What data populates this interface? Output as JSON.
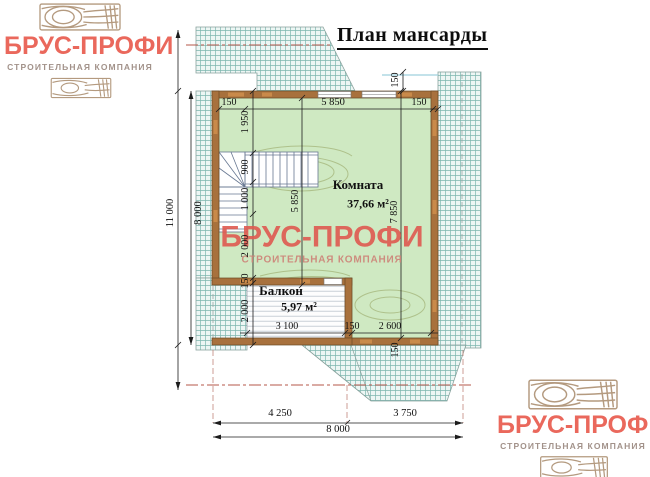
{
  "brand": {
    "name": "БРУС-ПРОФИ",
    "tagline": "СТРОИТЕЛЬНАЯ КОМПАНИЯ"
  },
  "title": "План мансарды",
  "rooms": {
    "room": {
      "name": "Комната",
      "area": "37,66 м²"
    },
    "balcony": {
      "name": "Балкон",
      "area": "5,97 м²"
    }
  },
  "dims": {
    "top_left_wall": "150",
    "top_width": "5 850",
    "top_right_wall": "150",
    "roof_offset": "150",
    "outer_height": "11 000",
    "inner_height": "8 000",
    "chain": [
      "1 950",
      "900",
      "1 000",
      "2 000",
      "150",
      "2 000"
    ],
    "room_height": "5 850",
    "right_height": "7 850",
    "balcony_width": "3 100",
    "balcony_wall": "150",
    "extension_width": "2 600",
    "bottom_wall": "150",
    "bottom_left": "4 250",
    "bottom_right": "3 750",
    "total_width": "8 000"
  },
  "colors": {
    "brand_red": "#ea685c",
    "roof_hatch_line": "#7db6af",
    "wall_brown": "#a8713d",
    "room_green": "#cfe9c2"
  }
}
